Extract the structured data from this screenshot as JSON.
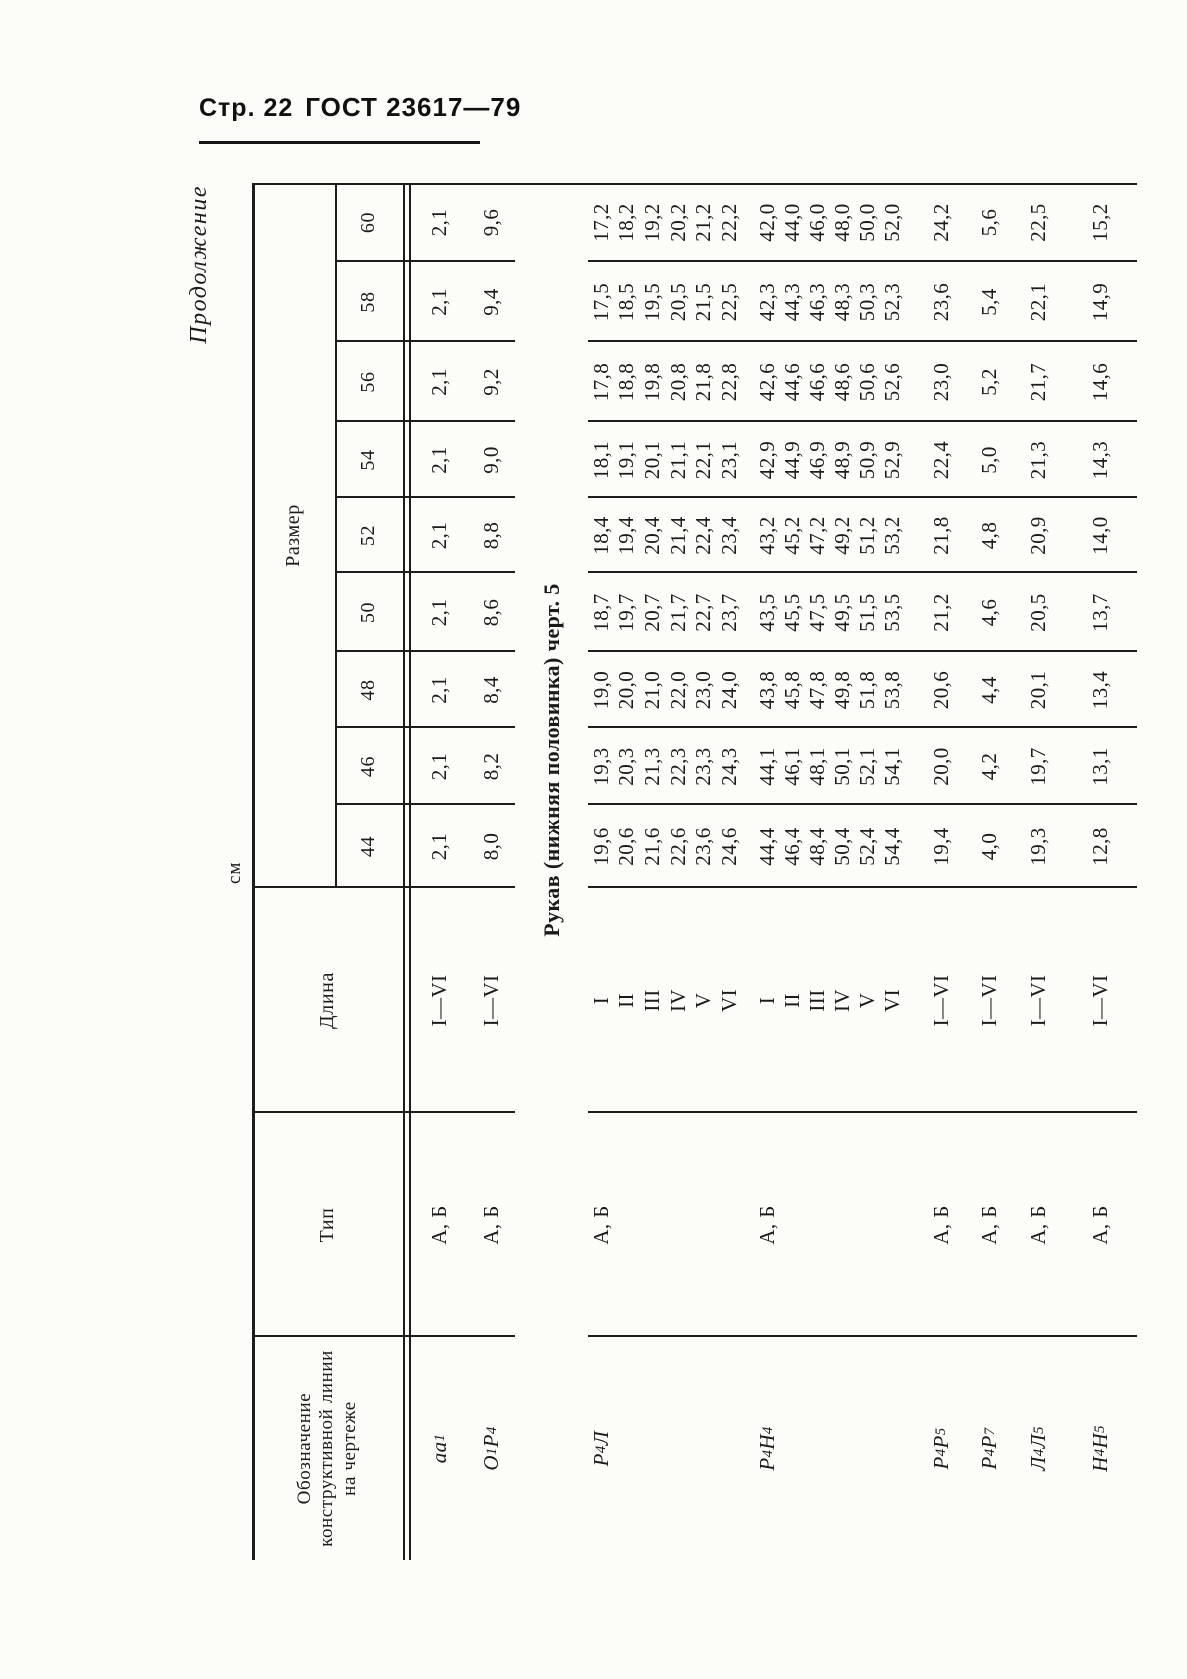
{
  "page_header": {
    "page_label": "Стр. 22",
    "doc_label": "ГОСТ 23617—79"
  },
  "continuation_note": "Продолжение",
  "unit_note": "см",
  "table": {
    "headers": {
      "designation": "Обозначение\nконструктивной линии\nна чертеже",
      "type": "Тип",
      "length": "Длина",
      "size_group": "Размер"
    },
    "sizes": [
      "44",
      "46",
      "48",
      "50",
      "52",
      "54",
      "56",
      "58",
      "60"
    ],
    "rows": [
      {
        "designation": "аа_1",
        "type": "А, Б",
        "length": "I—VI",
        "values": [
          "2,1",
          "2,1",
          "2,1",
          "2,1",
          "2,1",
          "2,1",
          "2,1",
          "2,1",
          "2,1"
        ]
      },
      {
        "designation": "О_1Р_4",
        "type": "А, Б",
        "length": "I—VI",
        "values": [
          "8,0",
          "8,2",
          "8,4",
          "8,6",
          "8,8",
          "9,0",
          "9,2",
          "9,4",
          "9,6"
        ]
      },
      {
        "section": "Рукав (нижняя половинка) черт. 5"
      },
      {
        "designation": "Р_4Л",
        "type": "А, Б",
        "subrows": [
          {
            "length": "I",
            "values": [
              "19,6",
              "19,3",
              "19,0",
              "18,7",
              "18,4",
              "18,1",
              "17,8",
              "17,5",
              "17,2"
            ]
          },
          {
            "length": "II",
            "values": [
              "20,6",
              "20,3",
              "20,0",
              "19,7",
              "19,4",
              "19,1",
              "18,8",
              "18,5",
              "18,2"
            ]
          },
          {
            "length": "III",
            "values": [
              "21,6",
              "21,3",
              "21,0",
              "20,7",
              "20,4",
              "20,1",
              "19,8",
              "19,5",
              "19,2"
            ]
          },
          {
            "length": "IV",
            "values": [
              "22,6",
              "22,3",
              "22,0",
              "21,7",
              "21,4",
              "21,1",
              "20,8",
              "20,5",
              "20,2"
            ]
          },
          {
            "length": "V",
            "values": [
              "23,6",
              "23,3",
              "23,0",
              "22,7",
              "22,4",
              "22,1",
              "21,8",
              "21,5",
              "21,2"
            ]
          },
          {
            "length": "VI",
            "values": [
              "24,6",
              "24,3",
              "24,0",
              "23,7",
              "23,4",
              "23,1",
              "22,8",
              "22,5",
              "22,2"
            ]
          }
        ]
      },
      {
        "designation": "Р_4Н_4",
        "type": "А, Б",
        "subrows": [
          {
            "length": "I",
            "values": [
              "44,4",
              "44,1",
              "43,8",
              "43,5",
              "43,2",
              "42,9",
              "42,6",
              "42,3",
              "42,0"
            ]
          },
          {
            "length": "II",
            "values": [
              "46,4",
              "46,1",
              "45,8",
              "45,5",
              "45,2",
              "44,9",
              "44,6",
              "44,3",
              "44,0"
            ]
          },
          {
            "length": "III",
            "values": [
              "48,4",
              "48,1",
              "47,8",
              "47,5",
              "47,2",
              "46,9",
              "46,6",
              "46,3",
              "46,0"
            ]
          },
          {
            "length": "IV",
            "values": [
              "50,4",
              "50,1",
              "49,8",
              "49,5",
              "49,2",
              "48,9",
              "48,6",
              "48,3",
              "48,0"
            ]
          },
          {
            "length": "V",
            "values": [
              "52,4",
              "52,1",
              "51,8",
              "51,5",
              "51,2",
              "50,9",
              "50,6",
              "50,3",
              "50,0"
            ]
          },
          {
            "length": "VI",
            "values": [
              "54,4",
              "54,1",
              "53,8",
              "53,5",
              "53,2",
              "52,9",
              "52,6",
              "52,3",
              "52,0"
            ]
          }
        ]
      },
      {
        "designation": "Р_4Р_5",
        "type": "А, Б",
        "length": "I—VI",
        "values": [
          "19,4",
          "20,0",
          "20,6",
          "21,2",
          "21,8",
          "22,4",
          "23,0",
          "23,6",
          "24,2"
        ]
      },
      {
        "designation": "Р_4Р_7",
        "type": "А, Б",
        "length": "I—VI",
        "values": [
          "4,0",
          "4,2",
          "4,4",
          "4,6",
          "4,8",
          "5,0",
          "5,2",
          "5,4",
          "5,6"
        ]
      },
      {
        "designation": "Л_4Л_5",
        "type": "А, Б",
        "length": "I—VI",
        "values": [
          "19,3",
          "19,7",
          "20,1",
          "20,5",
          "20,9",
          "21,3",
          "21,7",
          "22,1",
          "22,5"
        ]
      },
      {
        "designation": "Н_4Н_5",
        "type": "А, Б",
        "length": "I—VI",
        "values": [
          "12,8",
          "13,1",
          "13,4",
          "13,7",
          "14,0",
          "14,3",
          "14,6",
          "14,9",
          "15,2"
        ]
      }
    ]
  }
}
